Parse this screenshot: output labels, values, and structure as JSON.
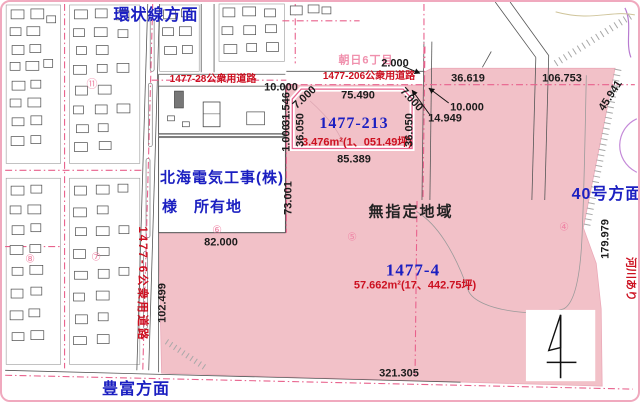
{
  "map": {
    "directions": {
      "top": "環状線方面",
      "bottom": "豊富方面",
      "right": "40号方面"
    },
    "district": "朝日6丁目",
    "zone": "無指定地域",
    "river": "河川あり",
    "owner": {
      "line1": "北海電気工事(株)",
      "line2": "様　所有地"
    },
    "roads": {
      "r28": "1477-28公衆用道路",
      "r206": "1477-206公衆用道路",
      "r6": "1477-6公衆用道路"
    },
    "parcels": {
      "p213": {
        "id": "1477-213",
        "area": "3.476m²(1、051.49坪)"
      },
      "p4": {
        "id": "1477-4",
        "area": "57.662m²(17、442.75坪)"
      }
    },
    "dims": {
      "d10a": "10.000",
      "d2": "2.000",
      "d36619": "36.619",
      "d106753": "106.753",
      "d45941": "45.941",
      "d10b": "10.000",
      "d14949": "14.949",
      "d75490": "75.490",
      "d7a": "7.000",
      "d7b": "7.000",
      "d36050a": "36.050",
      "d36050b": "36.050",
      "d31546": "31.546",
      "d1000": "1.000",
      "d85389": "85.389",
      "d73001": "73.001",
      "d82000": "82.000",
      "d102499": "102.499",
      "d179979": "179.979",
      "d321305": "321.305"
    },
    "markers": {
      "m11": "⑪",
      "m8": "⑧",
      "m7": "⑦",
      "m6": "⑥",
      "m5": "⑤",
      "m4": "④"
    },
    "colors": {
      "parcel_fill": "#f2c1c8",
      "boundary_pink": "#e8618c",
      "text_red": "#cc1020",
      "text_blue": "#1b1fc1",
      "text_pink": "#f090ad"
    }
  }
}
